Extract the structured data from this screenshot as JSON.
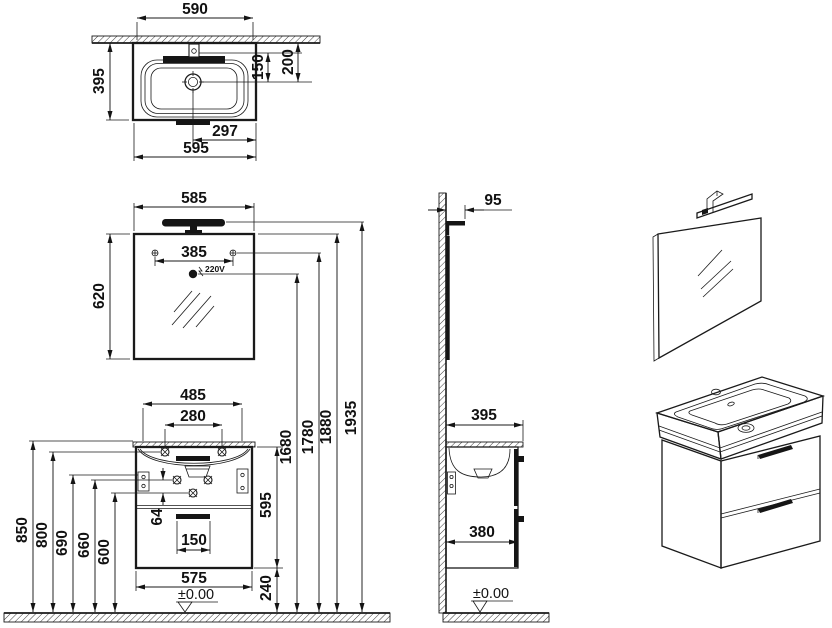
{
  "colors": {
    "line": "#1a1a1a",
    "background": "#ffffff",
    "fill_dark": "#151515"
  },
  "plan": {
    "w590": "590",
    "h395": "395",
    "d150": "150",
    "d200": "200",
    "d297": "297",
    "w595": "595"
  },
  "front": {
    "w585": "585",
    "h620": "620",
    "d385": "385",
    "socket": "220V",
    "d485": "485",
    "d280": "280",
    "h850": "850",
    "h800": "800",
    "h690": "690",
    "h660": "660",
    "h600": "600",
    "d64": "64",
    "d150": "150",
    "w575": "575",
    "h595": "595",
    "h240": "240",
    "h1680": "1680",
    "h1780": "1780",
    "h1880": "1880",
    "h1935": "1935",
    "datum": "±0.00"
  },
  "side": {
    "d95": "95",
    "d395": "395",
    "d380": "380",
    "datum": "±0.00"
  }
}
